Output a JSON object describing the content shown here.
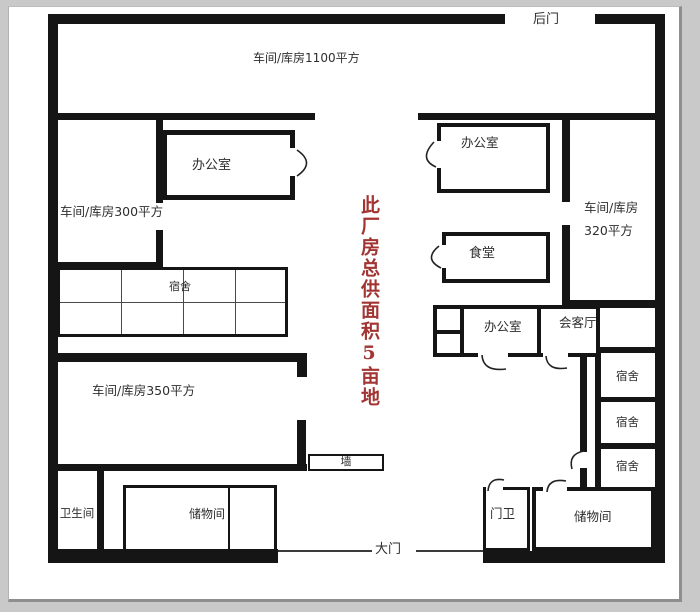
{
  "plan_labels": {
    "back_door": "后门",
    "main_gate": "大门",
    "workshop_1100": "车间/库房1100平方",
    "workshop_300": "车间/库房300平方",
    "workshop_350": "车间/库房350平方",
    "workshop_320_line1": "车间/库房",
    "workshop_320_line2": "320平方",
    "office_top_left": "办公室",
    "office_top_right": "办公室",
    "office_center": "办公室",
    "canteen": "食堂",
    "dorm_block": "宿舍",
    "dorm_1": "宿舍",
    "dorm_2": "宿舍",
    "dorm_3": "宿舍",
    "reception": "会客厅",
    "toilet": "卫生间",
    "storage_left": "储物间",
    "storage_right": "储物间",
    "guard_room": "门卫",
    "wall_marker": "墙",
    "red_note": "此厂房总供面积5亩地"
  },
  "colors": {
    "wall": "#151515",
    "note_red": "#a23533",
    "text": "#2e2e2e",
    "page": "#ffffff",
    "frame": "#c9c9c9"
  }
}
